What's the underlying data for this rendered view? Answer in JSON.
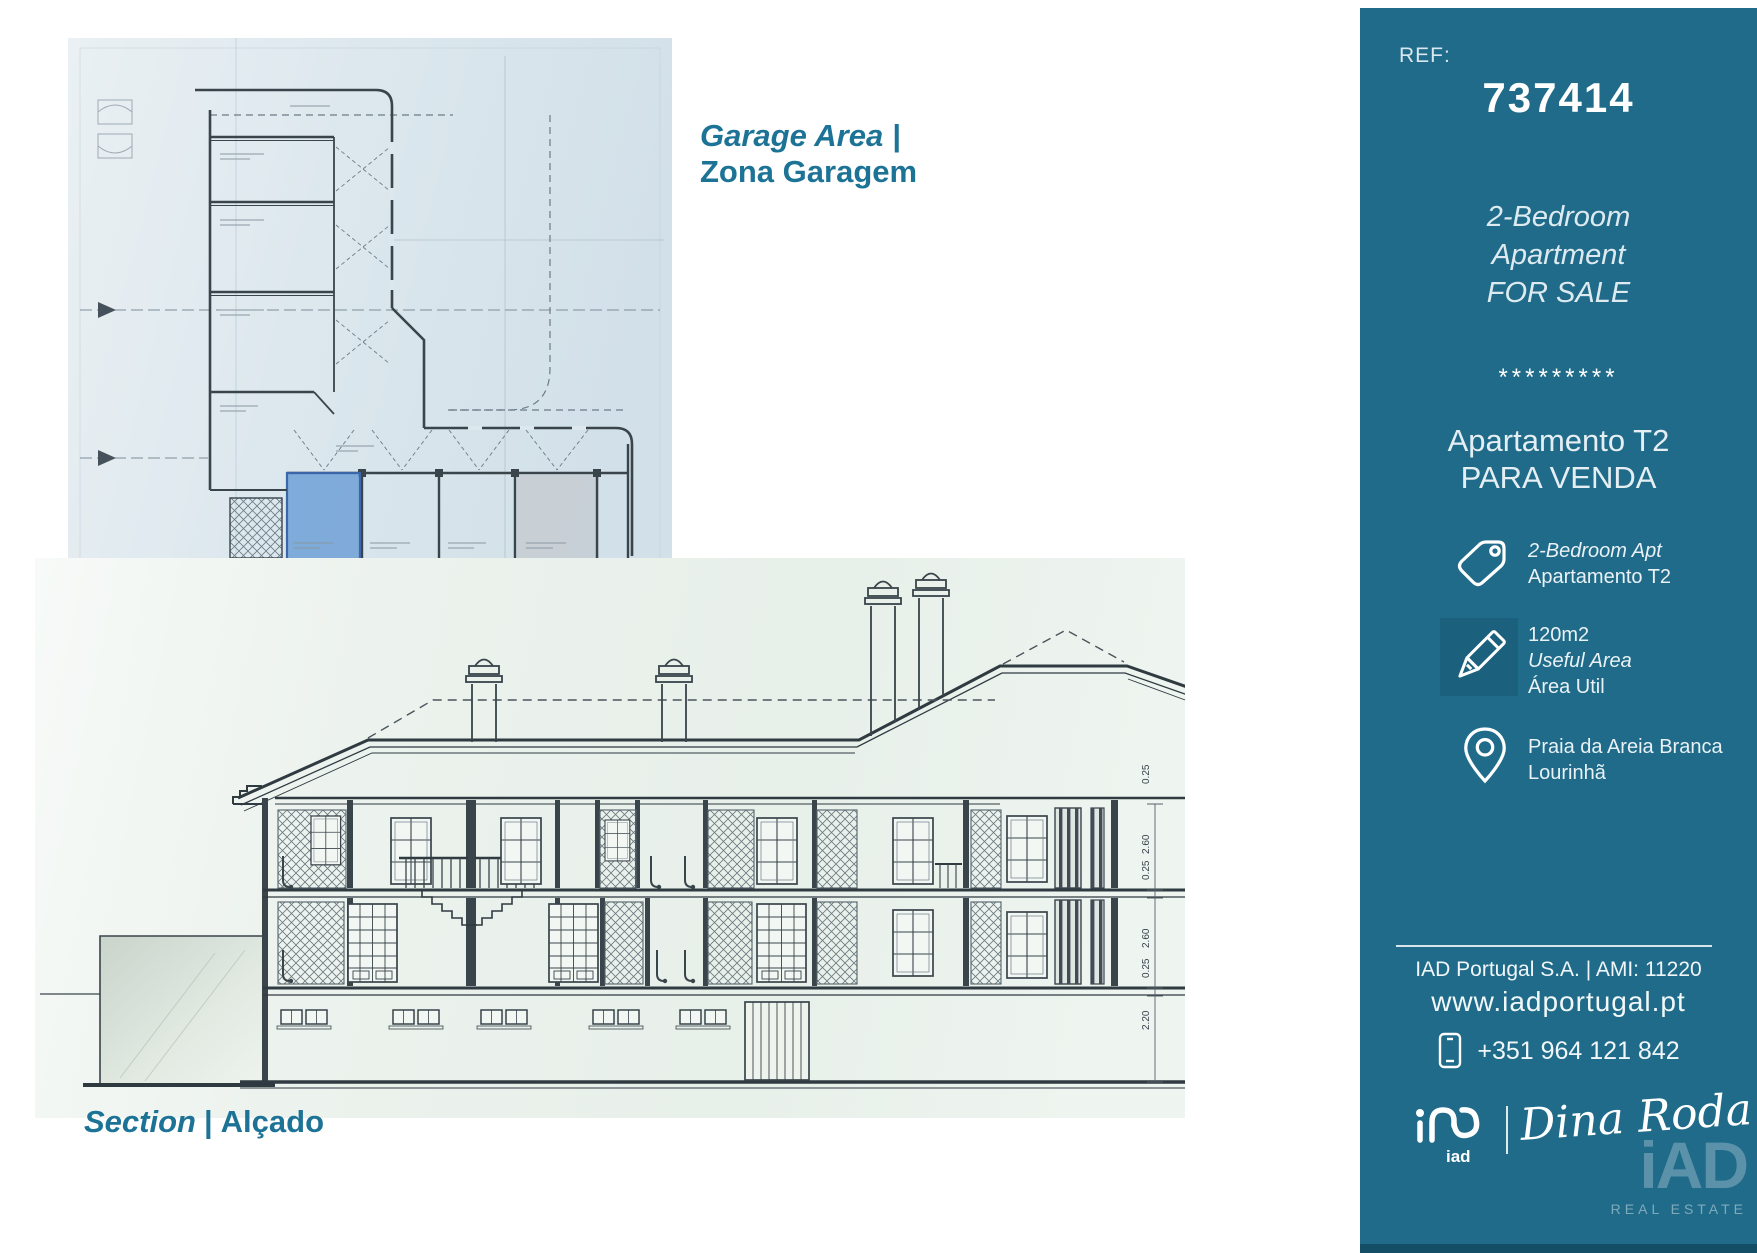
{
  "colors": {
    "sidebar_bg": "#1f6b89",
    "sidebar_bottom_strip": "#134d66",
    "accent_text": "#1d7396",
    "highlight_blue": "#6fa0d6",
    "plan_sheet": "#d9e4eb",
    "section_sheet": "#edf3ef"
  },
  "icons": {
    "tag": "tag-icon",
    "area": "pencil-icon",
    "location": "map-pin-icon",
    "phone": "mobile-phone-icon",
    "logo": "iad-logo"
  },
  "plan_caption": {
    "en": "Garage Area |",
    "pt": "Zona Garagem"
  },
  "section_caption": {
    "en": "Section",
    "sep": "|",
    "pt": "Alçado"
  },
  "sidebar": {
    "ref_label": "REF:",
    "ref_number": "737414",
    "title_en": {
      "line1": "2-Bedroom",
      "line2": "Apartment",
      "line3": "FOR SALE"
    },
    "stars": "*********",
    "title_pt": {
      "line1": "Apartamento T2",
      "line2": "PARA VENDA"
    },
    "features": {
      "tag": {
        "line1": "2-Bedroom Apt",
        "line2": "Apartamento T2"
      },
      "area": {
        "line1": "120m2",
        "line2": "Useful Area",
        "line3": "Área Util"
      },
      "location": {
        "line1": "Praia da Areia Branca",
        "line2": "Lourinhã"
      }
    },
    "footer": {
      "company": "IAD Portugal S.A. | AMI: 11220",
      "website": "www.iadportugal.pt",
      "phone": "+351 964 121 842"
    },
    "brand": {
      "logo_text": "iad",
      "agent": "Dina Roda",
      "watermark_main": "iAD",
      "watermark_sub": "REAL ESTATE"
    }
  },
  "drawings": {
    "section": {
      "dims_left": [
        "0.25",
        "2.60",
        "0.25",
        "2.60",
        "0.25",
        "2.20"
      ],
      "dims_right": [
        "0.90",
        "1.40",
        "3.00",
        "0.80",
        "1.40",
        "3.00"
      ]
    }
  }
}
